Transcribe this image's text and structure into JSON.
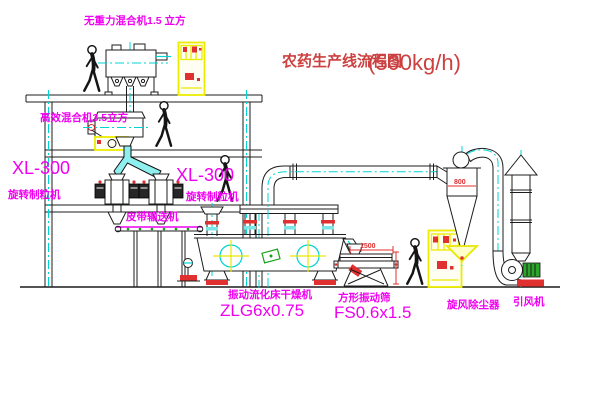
{
  "title": {
    "text": "农药生产线流程图",
    "capacity": "(500kg/h)"
  },
  "equipment_labels": {
    "top_mixer": "无重力混合机1.5 立方",
    "mid_mixer": "高效混合机3.5立方",
    "granulator_left": {
      "model": "XL-300",
      "name": "旋转制粒机"
    },
    "granulator_right": {
      "model": "XL-300",
      "name": "旋转制粒机"
    },
    "belt_conveyor": "皮带输送机",
    "dryer": {
      "name": "振动流化床干燥机",
      "model": "ZLG6x0.75"
    },
    "sieve": {
      "name": "方形振动筛",
      "model": "FS0.6x1.5"
    },
    "cyclone": "旋风除尘器",
    "fan": "引风机"
  },
  "dimensions": {
    "sieve_length": "1500",
    "cyclone_diameter": "800"
  },
  "colors": {
    "line": "#1c1c1c",
    "label_magenta": "#f000f0",
    "title_red": "#cc4040",
    "dimension_red": "#e03030",
    "centerline_cyan": "#00d4d4",
    "cabinet_yellow": "#ecec00",
    "accent_green": "#17a017",
    "background": "#ffffff"
  }
}
